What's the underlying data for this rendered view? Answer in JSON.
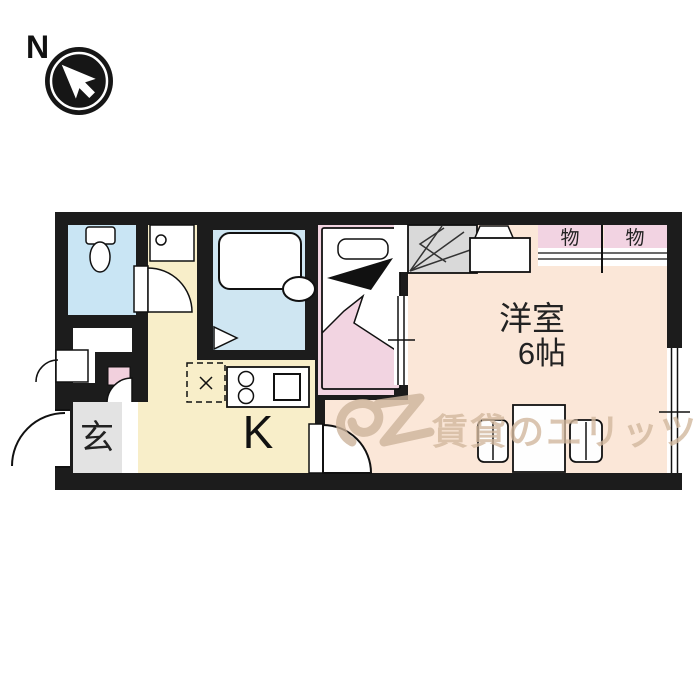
{
  "compass": {
    "label": "N"
  },
  "floorplan": {
    "entrance_label": "玄",
    "kitchen_label": "K",
    "main_room_label_line1": "洋室",
    "main_room_label_line2": "6帖",
    "closet_left_label": "物",
    "closet_right_label": "物"
  },
  "watermark": {
    "text": "賃貸のエリッツ"
  },
  "colors": {
    "wall": "#1c1c1c",
    "toilet_floor": "#c9e5f4",
    "bath_floor": "#cfe6f2",
    "kitchen_floor": "#f8eec9",
    "main_room_floor": "#fbe7d8",
    "bed_pink": "#f2d4e1",
    "closet_pink": "#f2d3e2",
    "entrance_gray": "#e3e3e3",
    "stairs_gray": "#d9d9d9",
    "watermark_tan": "#d2b89e"
  }
}
